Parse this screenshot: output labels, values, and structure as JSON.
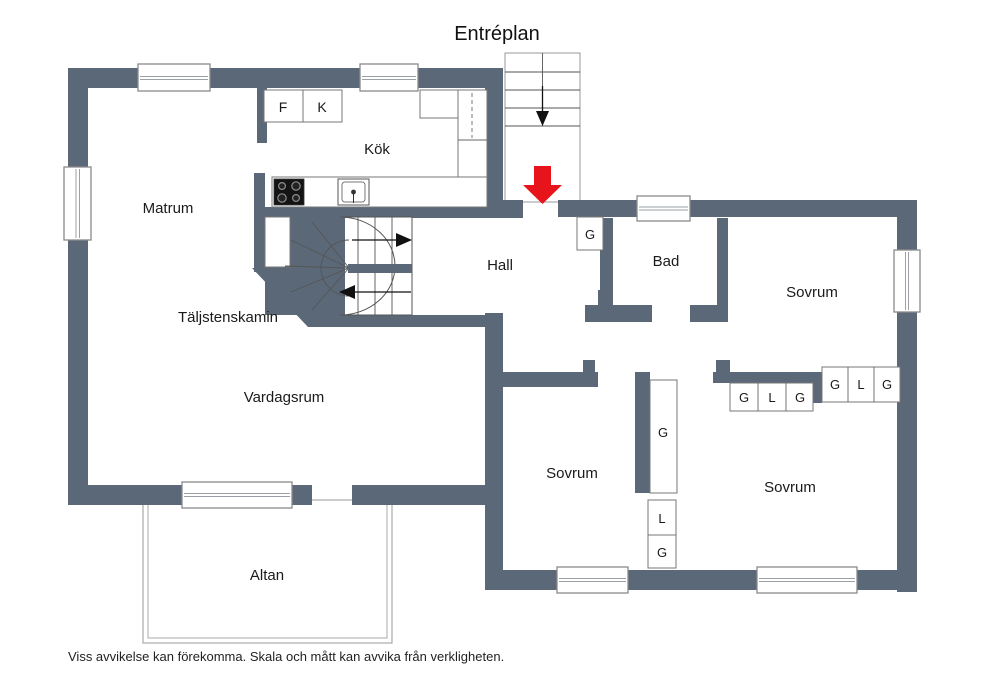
{
  "title": "Entréplan",
  "disclaimer": "Viss avvikelse kan förekomma. Skala och mått kan avvika från verkligheten.",
  "colors": {
    "wall": "#5b6878",
    "floor": "#ffffff",
    "entrance_arrow": "#e8141c",
    "window_frame": "#8a8a8a"
  },
  "rooms": {
    "matrum": "Matrum",
    "kok": "Kök",
    "hall": "Hall",
    "bad": "Bad",
    "sovrum_ne": "Sovrum",
    "sovrum_sw": "Sovrum",
    "sovrum_se": "Sovrum",
    "vardagsrum": "Vardagsrum",
    "taljstenskamin": "Täljstenskamin",
    "altan": "Altan"
  },
  "fixtures": {
    "f": "F",
    "k": "K"
  },
  "closets": {
    "hall_g": "G",
    "tall_g": "G",
    "mid_l": "L",
    "mid_g": "G",
    "row_lower": [
      "G",
      "L",
      "G"
    ],
    "row_upper": [
      "G",
      "L",
      "G"
    ]
  }
}
